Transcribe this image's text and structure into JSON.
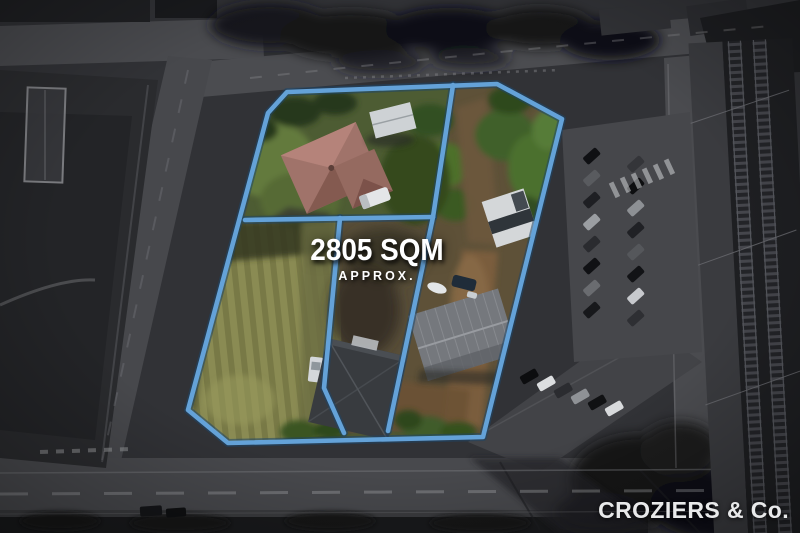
{
  "overlay": {
    "area_label": "2805 SQM",
    "area_qualifier": "APPROX."
  },
  "branding": {
    "agency_name": "CROZIERS & Co."
  },
  "colors": {
    "boundary_blue": "#64A2D8",
    "overlay_text": "#FFFFFF",
    "brand_text": "#E8E9EA"
  }
}
